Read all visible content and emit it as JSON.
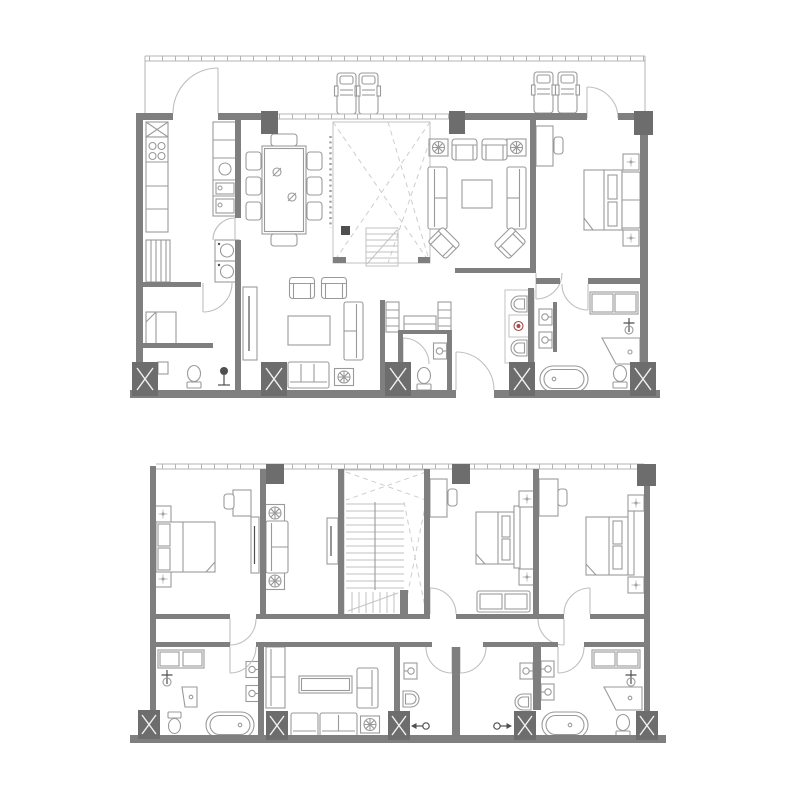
{
  "document": {
    "title": "Two-storey apartment floor plans",
    "background": "#ffffff"
  },
  "colors": {
    "wall": "#7f7f7f",
    "column": "#6d6d6d",
    "column_x": "#f2f2f2",
    "furniture": "#9a9a9a",
    "light": "#c2c2c2",
    "window": "#b4b4b4",
    "door": "#bfbfbf",
    "void_line": "#cdcdcd",
    "screen": "#9f9f9f",
    "fixture_dark": "#4f4f4f",
    "accent": "#a34a4a",
    "bg": "#ffffff"
  },
  "plans": [
    {
      "id": "upper-floor-plan",
      "position": "top",
      "rooms": [
        {
          "name": "terrace",
          "symbols": [
            "railing-with-ticks",
            "lounge-chair",
            "lounge-chair",
            "lounge-chair",
            "lounge-chair",
            "terrace-door",
            "terrace-door"
          ]
        },
        {
          "name": "kitchen",
          "symbols": [
            "upper-cabinet-x",
            "cooktop-4-burners",
            "counter-run",
            "island-counter",
            "round-sink",
            "oven-module",
            "washer",
            "dryer",
            "pantry-shelves",
            "door-arc"
          ]
        },
        {
          "name": "dining",
          "symbols": [
            "dining-table",
            "chair",
            "chair",
            "chair",
            "chair",
            "chair",
            "chair",
            "chair",
            "chair",
            "table-decor",
            "table-decor"
          ]
        },
        {
          "name": "double-height-void",
          "symbols": [
            "dashed-void-x",
            "dotted-screen",
            "stair-flight-down",
            "newel-post"
          ]
        },
        {
          "name": "living-room",
          "symbols": [
            "plant-side-table",
            "armchair",
            "armchair",
            "plant-side-table",
            "sofa",
            "sofa",
            "coffee-table",
            "diagonal-armchair",
            "diagonal-armchair"
          ]
        },
        {
          "name": "family-lounge",
          "symbols": [
            "tv-console",
            "armchair",
            "armchair",
            "coffee-table",
            "sofa",
            "bench-sofa",
            "plant-side-table"
          ]
        },
        {
          "name": "maid-room",
          "symbols": [
            "single-bed",
            "cabinet",
            "door-arc"
          ]
        },
        {
          "name": "maid-bath",
          "symbols": [
            "toilet",
            "shower-drain",
            "cabinet"
          ]
        },
        {
          "name": "entry-hall",
          "symbols": [
            "entry-door-arc",
            "linen-closet",
            "linen-closet",
            "wardrobe"
          ]
        },
        {
          "name": "hall-bathroom",
          "symbols": [
            "toilet",
            "wall-sink",
            "door-arc"
          ]
        },
        {
          "name": "powder-room",
          "symbols": [
            "toilet",
            "red-accent-basin",
            "toilet",
            "wall-sink",
            "wall-sink"
          ]
        },
        {
          "name": "master-bathroom",
          "symbols": [
            "vanity-cabinet",
            "faucet-stand",
            "shower-tray",
            "toilet",
            "bathtub",
            "door-arc"
          ]
        },
        {
          "name": "master-bedroom",
          "symbols": [
            "desk",
            "desk-chair",
            "double-bed",
            "nightstand",
            "wardrobe-headboard",
            "nightstand",
            "door-arc"
          ]
        }
      ],
      "structure": [
        "solid-column",
        "solid-column",
        "solid-column",
        "shaft-column-x",
        "shaft-column-x",
        "shaft-column-x",
        "shaft-column-x",
        "shaft-column-x"
      ]
    },
    {
      "id": "lower-floor-plan",
      "position": "bottom",
      "rooms": [
        {
          "name": "bedroom-left",
          "symbols": [
            "nightstand",
            "double-bed",
            "nightstand",
            "desk",
            "desk-chair",
            "wardrobe"
          ]
        },
        {
          "name": "sitting-nook",
          "symbols": [
            "plant-side-table",
            "loveseat",
            "plant-side-table",
            "wardrobe"
          ]
        },
        {
          "name": "stair-hall",
          "symbols": [
            "u-stair-treads",
            "dashed-void-x",
            "landing-flight"
          ]
        },
        {
          "name": "bedroom-middle",
          "symbols": [
            "desk",
            "desk-chair",
            "double-bed",
            "nightstand",
            "nightstand",
            "foot-bench",
            "door-arc"
          ]
        },
        {
          "name": "bedroom-right",
          "symbols": [
            "desk",
            "desk-chair",
            "double-bed",
            "nightstand",
            "nightstand",
            "door-arc"
          ]
        },
        {
          "name": "corridor",
          "symbols": [
            "door-arc",
            "door-arc"
          ]
        },
        {
          "name": "bathroom-left",
          "symbols": [
            "vanity-cabinet",
            "faucet-stand",
            "shower-tray",
            "toilet",
            "bathtub",
            "wall-sink",
            "wall-sink",
            "door-arc"
          ]
        },
        {
          "name": "family-lounge",
          "symbols": [
            "tall-cabinet",
            "long-table",
            "sofa",
            "sofa",
            "sofa",
            "plant-side-table"
          ]
        },
        {
          "name": "shower-room-left",
          "symbols": [
            "wall-sink",
            "toilet",
            "shower-spray",
            "door-arc"
          ]
        },
        {
          "name": "shower-room-right",
          "symbols": [
            "wall-sink",
            "toilet",
            "shower-spray",
            "door-arc"
          ]
        },
        {
          "name": "master-bathroom",
          "symbols": [
            "wall-sink",
            "wall-sink",
            "vanity-cabinet",
            "faucet-stand",
            "shower-tray",
            "toilet",
            "bathtub",
            "door-arc"
          ]
        }
      ],
      "structure": [
        "solid-column",
        "solid-column",
        "solid-column",
        "shaft-column-x",
        "shaft-column-x",
        "shaft-column-x",
        "shaft-column-x",
        "shaft-column-x"
      ]
    }
  ]
}
